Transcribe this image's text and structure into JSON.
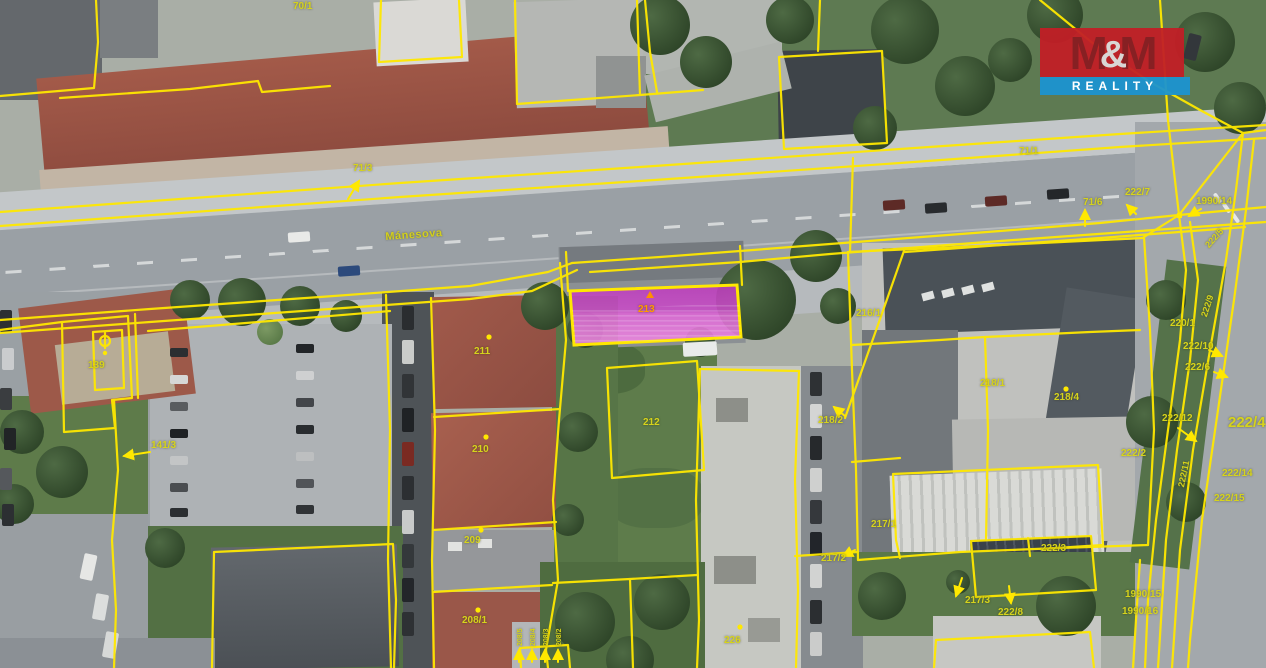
{
  "logo": {
    "m1": "M",
    "amp": "&",
    "m2": "M",
    "reality": "REALITY",
    "red": "#c11f26",
    "blue": "#1b93d0"
  },
  "map": {
    "street_name": "Mánesova",
    "highlighted_parcel": "213",
    "line_color": "#ffe800",
    "highlight_fill": "#d94fd4",
    "labels": [
      {
        "text": "70/1",
        "x": 293,
        "y": 1
      },
      {
        "text": "71/3",
        "x": 353,
        "y": 163
      },
      {
        "text": "Mánesova",
        "x": 385,
        "y": 231,
        "rot": -4,
        "cls": "street"
      },
      {
        "text": "71/1",
        "x": 1019,
        "y": 146
      },
      {
        "text": "71/6",
        "x": 1083,
        "y": 197
      },
      {
        "text": "222/7",
        "x": 1125,
        "y": 187
      },
      {
        "text": "1990/14",
        "x": 1196,
        "y": 196
      },
      {
        "text": "222/5",
        "x": 1203,
        "y": 243,
        "rot": -48,
        "size": 9
      },
      {
        "text": "222/9",
        "x": 1199,
        "y": 315,
        "rot": -72,
        "size": 9
      },
      {
        "text": "220/1",
        "x": 1170,
        "y": 318
      },
      {
        "text": "222/10",
        "x": 1183,
        "y": 341
      },
      {
        "text": "222/6",
        "x": 1185,
        "y": 362
      },
      {
        "text": "222/12",
        "x": 1162,
        "y": 413
      },
      {
        "text": "222/4",
        "x": 1228,
        "y": 414,
        "size": 15
      },
      {
        "text": "222/2",
        "x": 1121,
        "y": 448
      },
      {
        "text": "222/14",
        "x": 1222,
        "y": 468
      },
      {
        "text": "222/15",
        "x": 1214,
        "y": 493
      },
      {
        "text": "222/11",
        "x": 1176,
        "y": 486,
        "rot": -78,
        "size": 9
      },
      {
        "text": "216/1",
        "x": 856,
        "y": 308
      },
      {
        "text": "218/1",
        "x": 980,
        "y": 378
      },
      {
        "text": "218/4",
        "x": 1054,
        "y": 392
      },
      {
        "text": "218/2",
        "x": 818,
        "y": 415
      },
      {
        "text": "217/1",
        "x": 871,
        "y": 519
      },
      {
        "text": "217/2",
        "x": 821,
        "y": 553
      },
      {
        "text": "217/3",
        "x": 965,
        "y": 595
      },
      {
        "text": "222/8",
        "x": 998,
        "y": 607
      },
      {
        "text": "222/3",
        "x": 1041,
        "y": 543
      },
      {
        "text": "1990/15",
        "x": 1125,
        "y": 589
      },
      {
        "text": "1990/16",
        "x": 1122,
        "y": 606
      },
      {
        "text": "212",
        "x": 643,
        "y": 417
      },
      {
        "text": "213",
        "x": 638,
        "y": 304,
        "cls": "highlight"
      },
      {
        "text": "211",
        "x": 474,
        "y": 346
      },
      {
        "text": "210",
        "x": 472,
        "y": 444
      },
      {
        "text": "209",
        "x": 464,
        "y": 535
      },
      {
        "text": "208/1",
        "x": 462,
        "y": 615
      },
      {
        "text": "226",
        "x": 724,
        "y": 635
      },
      {
        "text": "139",
        "x": 88,
        "y": 360
      },
      {
        "text": "141/3",
        "x": 151,
        "y": 440
      },
      {
        "text": "208/2",
        "x": 556,
        "y": 646,
        "rot": -90,
        "size": 7
      },
      {
        "text": "208/3",
        "x": 543,
        "y": 646,
        "rot": -90,
        "size": 7
      },
      {
        "text": "208/4",
        "x": 530,
        "y": 646,
        "rot": -90,
        "size": 7
      },
      {
        "text": "208/5",
        "x": 517,
        "y": 646,
        "rot": -90,
        "size": 7
      }
    ]
  }
}
